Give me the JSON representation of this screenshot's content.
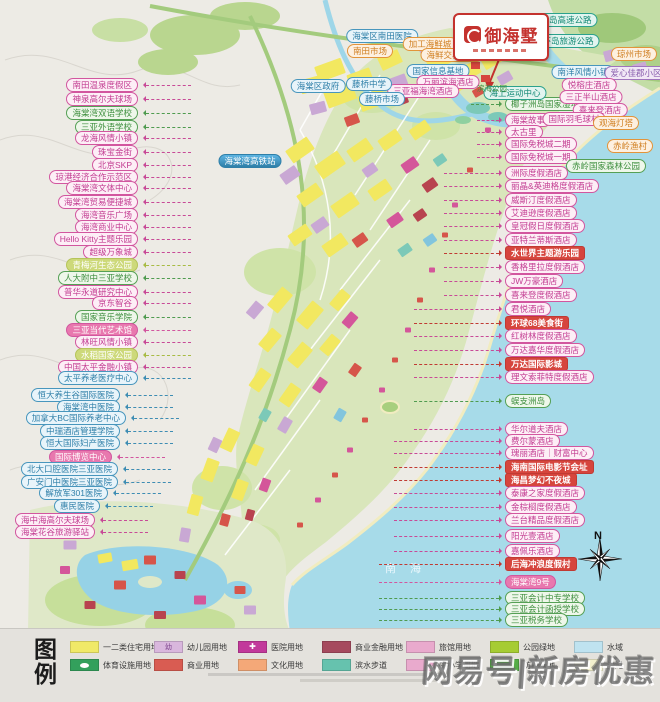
{
  "app": {
    "compass": "N",
    "sea_label": "南海",
    "watermark": "网易号|新房优惠"
  },
  "logo": {
    "title": "御海墅"
  },
  "legend": {
    "title": "图例",
    "row1": [
      {
        "label": "一二类住宅用地",
        "color": "#f0e968"
      },
      {
        "label": "幼儿园用地",
        "color": "#d9b7dd",
        "swatch_text": "幼"
      },
      {
        "label": "医院用地",
        "color": "#c2399b",
        "icon": "cross"
      },
      {
        "label": "商业金融用地",
        "color": "#a64a5e"
      },
      {
        "label": "旅馆用地",
        "color": "#e9aacd"
      },
      {
        "label": "公园绿地",
        "color": "#a6cc33"
      },
      {
        "label": "水域",
        "color": "#bfe3f0"
      }
    ],
    "row2": [
      {
        "label": "体育设施用地",
        "color": "#33a05c",
        "icon": "oval"
      },
      {
        "label": "商业用地",
        "color": "#d95c52"
      },
      {
        "label": "文化用地",
        "color": "#f4a878"
      },
      {
        "label": "滨水步道",
        "color": "#66c2ae"
      },
      {
        "label": "中小学用地",
        "color": "#e9aacd"
      },
      {
        "label": "防护绿地",
        "color": "#55ad47"
      },
      {
        "label": "沙滩",
        "color": "#f3f0cd"
      }
    ]
  },
  "labels": {
    "left": [
      {
        "t": "南田温泉度假区",
        "y": 85,
        "type": "pink"
      },
      {
        "t": "神泉高尔夫球场",
        "y": 99,
        "type": "pink"
      },
      {
        "t": "海棠湾双语学校",
        "y": 113,
        "type": "green"
      },
      {
        "t": "三亚外语学校",
        "y": 127,
        "type": "green"
      },
      {
        "t": "龙海风情小镇",
        "y": 138,
        "type": "pink"
      },
      {
        "t": "珠宝金街",
        "y": 152,
        "type": "pink"
      },
      {
        "t": "北京SKP",
        "y": 165,
        "type": "pink"
      },
      {
        "t": "琼港经济合作示范区",
        "y": 177,
        "type": "pink"
      },
      {
        "t": "海棠湾文体中心",
        "y": 188,
        "type": "pink"
      },
      {
        "t": "海棠湾贸易便捷城",
        "y": 202,
        "type": "pink"
      },
      {
        "t": "海湾音乐广场",
        "y": 215,
        "type": "pink"
      },
      {
        "t": "海湾商业中心",
        "y": 227,
        "type": "pink"
      },
      {
        "t": "Hello Kitty主题乐园",
        "y": 239,
        "type": "pink"
      },
      {
        "t": "超级万象城",
        "y": 252,
        "type": "pink"
      },
      {
        "t": "青梅河生态公园",
        "y": 265,
        "type": "lime-solid"
      },
      {
        "t": "人大附中三亚学校",
        "y": 278,
        "type": "green"
      },
      {
        "t": "普华永道研究中心",
        "y": 292,
        "type": "pink"
      },
      {
        "t": "京东智谷",
        "y": 303,
        "type": "pink"
      },
      {
        "t": "国家音乐学院",
        "y": 317,
        "type": "green"
      },
      {
        "t": "三亚当代艺术馆",
        "y": 330,
        "type": "pink-solid"
      },
      {
        "t": "林旺风情小镇",
        "y": 342,
        "type": "pink"
      },
      {
        "t": "水稻国家公园",
        "y": 355,
        "type": "lime-solid"
      },
      {
        "t": "中国太平金融小镇",
        "y": 367,
        "type": "pink"
      },
      {
        "t": "太平养老医疗中心",
        "y": 378,
        "type": "blue"
      },
      {
        "t": "恒大养生谷国际医院",
        "y": 395,
        "type": "blue",
        "r": 120
      },
      {
        "t": "海棠湾中医院",
        "y": 407,
        "type": "blue",
        "r": 120
      },
      {
        "t": "加拿大BC国际养老中心",
        "y": 418,
        "type": "blue",
        "r": 126
      },
      {
        "t": "中瑞酒店管理学院",
        "y": 431,
        "type": "blue",
        "r": 120
      },
      {
        "t": "恒大国际妇产医院",
        "y": 443,
        "type": "blue",
        "r": 120
      },
      {
        "t": "国际博览中心",
        "y": 457,
        "type": "pink-solid",
        "r": 112
      },
      {
        "t": "北大口腔医院三亚医院",
        "y": 469,
        "type": "blue",
        "r": 118
      },
      {
        "t": "广安门中医院三亚医院",
        "y": 482,
        "type": "blue",
        "r": 118
      },
      {
        "t": "解放军301医院",
        "y": 493,
        "type": "blue",
        "r": 108
      },
      {
        "t": "惠民医院",
        "y": 506,
        "type": "blue",
        "r": 100
      },
      {
        "t": "海中海高尔夫球场",
        "y": 520,
        "type": "pink",
        "r": 95
      },
      {
        "t": "海棠花谷旅游驿站",
        "y": 532,
        "type": "pink",
        "r": 95
      }
    ],
    "right": [
      {
        "t": "椰子洲岛国家湿地公园",
        "y": 104,
        "type": "green",
        "len": 28
      },
      {
        "t": "海棠故事",
        "y": 120,
        "type": "pink"
      },
      {
        "t": "太古里",
        "y": 132,
        "type": "pink"
      },
      {
        "t": "国际免税城二期",
        "y": 144,
        "type": "pink"
      },
      {
        "t": "国际免税城一期",
        "y": 157,
        "type": "pink"
      },
      {
        "t": "洲际度假酒店",
        "y": 173,
        "type": "pink"
      },
      {
        "t": "丽晶&英迪格度假酒店",
        "y": 186,
        "type": "pink"
      },
      {
        "t": "威斯汀度假酒店",
        "y": 200,
        "type": "pink"
      },
      {
        "t": "艾迪逊度假酒店",
        "y": 213,
        "type": "pink"
      },
      {
        "t": "皇冠假日度假酒店",
        "y": 226,
        "type": "pink"
      },
      {
        "t": "亚特兰蒂斯酒店",
        "y": 240,
        "type": "pink"
      },
      {
        "t": "水世界主题游乐园",
        "y": 253,
        "type": "red"
      },
      {
        "t": "香格里拉度假酒店",
        "y": 267,
        "type": "pink"
      },
      {
        "t": "JW万豪酒店",
        "y": 281,
        "type": "pink"
      },
      {
        "t": "喜来登度假酒店",
        "y": 295,
        "type": "pink"
      },
      {
        "t": "君悦酒店",
        "y": 309,
        "type": "pink"
      },
      {
        "t": "环球68美食街",
        "y": 323,
        "type": "red"
      },
      {
        "t": "红树林度假酒店",
        "y": 336,
        "type": "pink"
      },
      {
        "t": "万达嘉华度假酒店",
        "y": 350,
        "type": "pink"
      },
      {
        "t": "万达国际影城",
        "y": 364,
        "type": "red"
      },
      {
        "t": "理文索菲特度假酒店",
        "y": 377,
        "type": "pink"
      },
      {
        "t": "蜈支洲岛",
        "y": 401,
        "type": "green"
      },
      {
        "t": "华尔道夫酒店",
        "y": 429,
        "type": "pink"
      },
      {
        "t": "费尔蒙酒店",
        "y": 441,
        "type": "pink"
      },
      {
        "t": "瑰丽酒店｜财富中心",
        "y": 453,
        "type": "pink"
      },
      {
        "t": "海南国际电影节会址",
        "y": 467,
        "type": "red"
      },
      {
        "t": "海昌梦幻不夜城",
        "y": 480,
        "type": "red"
      },
      {
        "t": "泰康之家度假酒店",
        "y": 493,
        "type": "pink"
      },
      {
        "t": "金棕榈度假酒店",
        "y": 507,
        "type": "pink"
      },
      {
        "t": "兰台精品度假酒店",
        "y": 520,
        "type": "pink"
      },
      {
        "t": "阳光壹酒店",
        "y": 536,
        "type": "pink"
      },
      {
        "t": "嘉佩乐酒店",
        "y": 551,
        "type": "pink"
      },
      {
        "t": "后海冲浪度假村",
        "y": 564,
        "type": "red"
      },
      {
        "t": "海棠湾9号",
        "y": 582,
        "type": "pink-solid"
      },
      {
        "t": "三亚会计中专学校",
        "y": 598,
        "type": "green"
      },
      {
        "t": "三亚会计函授学校",
        "y": 609,
        "type": "green"
      },
      {
        "t": "三亚税务学校",
        "y": 620,
        "type": "green"
      }
    ],
    "onmap": [
      {
        "t": "环岛高速公路",
        "x": 566,
        "y": 20,
        "type": "teal"
      },
      {
        "t": "环岛旅游公路",
        "x": 568,
        "y": 41,
        "type": "teal"
      },
      {
        "t": "琼州市场",
        "x": 634,
        "y": 54,
        "type": "orange"
      },
      {
        "t": "南洋风情小镇",
        "x": 583,
        "y": 72,
        "type": "blue"
      },
      {
        "t": "爱心佳郡小区",
        "x": 636,
        "y": 73,
        "type": "purple"
      },
      {
        "t": "悦榕庄酒店",
        "x": 589,
        "y": 85,
        "type": "pink"
      },
      {
        "t": "三正半山酒店",
        "x": 591,
        "y": 97,
        "type": "pink"
      },
      {
        "t": "喜来登酒店",
        "x": 600,
        "y": 110,
        "type": "pink"
      },
      {
        "t": "国际羽毛球村",
        "x": 574,
        "y": 119,
        "type": "pink"
      },
      {
        "t": "观海灯塔",
        "x": 616,
        "y": 123,
        "type": "orange"
      },
      {
        "t": "赤岭渔村",
        "x": 630,
        "y": 146,
        "type": "orange"
      },
      {
        "t": "赤岭国家森林公园",
        "x": 606,
        "y": 166,
        "type": "green"
      },
      {
        "t": "海上运动中心",
        "x": 515,
        "y": 93,
        "type": "teal"
      },
      {
        "t": "海棠区南田医院",
        "x": 382,
        "y": 36,
        "type": "blue"
      },
      {
        "t": "南田市场",
        "x": 370,
        "y": 51,
        "type": "orange"
      },
      {
        "t": "加工海鲜城",
        "x": 430,
        "y": 44,
        "type": "orange"
      },
      {
        "t": "海鲜交易市场",
        "x": 452,
        "y": 55,
        "type": "orange"
      },
      {
        "t": "国家信息基地",
        "x": 438,
        "y": 71,
        "type": "blue"
      },
      {
        "t": "万丽滨海酒店",
        "x": 448,
        "y": 82,
        "type": "pink"
      },
      {
        "t": "三亚福海湾酒店",
        "x": 423,
        "y": 91,
        "type": "pink"
      },
      {
        "t": "海棠区政府",
        "x": 318,
        "y": 86,
        "type": "blue"
      },
      {
        "t": "藤桥中学",
        "x": 369,
        "y": 84,
        "type": "blue"
      },
      {
        "t": "藤桥市场",
        "x": 382,
        "y": 99,
        "type": "blue"
      },
      {
        "t": "海棠湾高铁站",
        "x": 250,
        "y": 161,
        "type": "blue-solid"
      },
      {
        "t": "滨海公园",
        "x": 492,
        "y": 89,
        "type": "plain"
      }
    ]
  }
}
